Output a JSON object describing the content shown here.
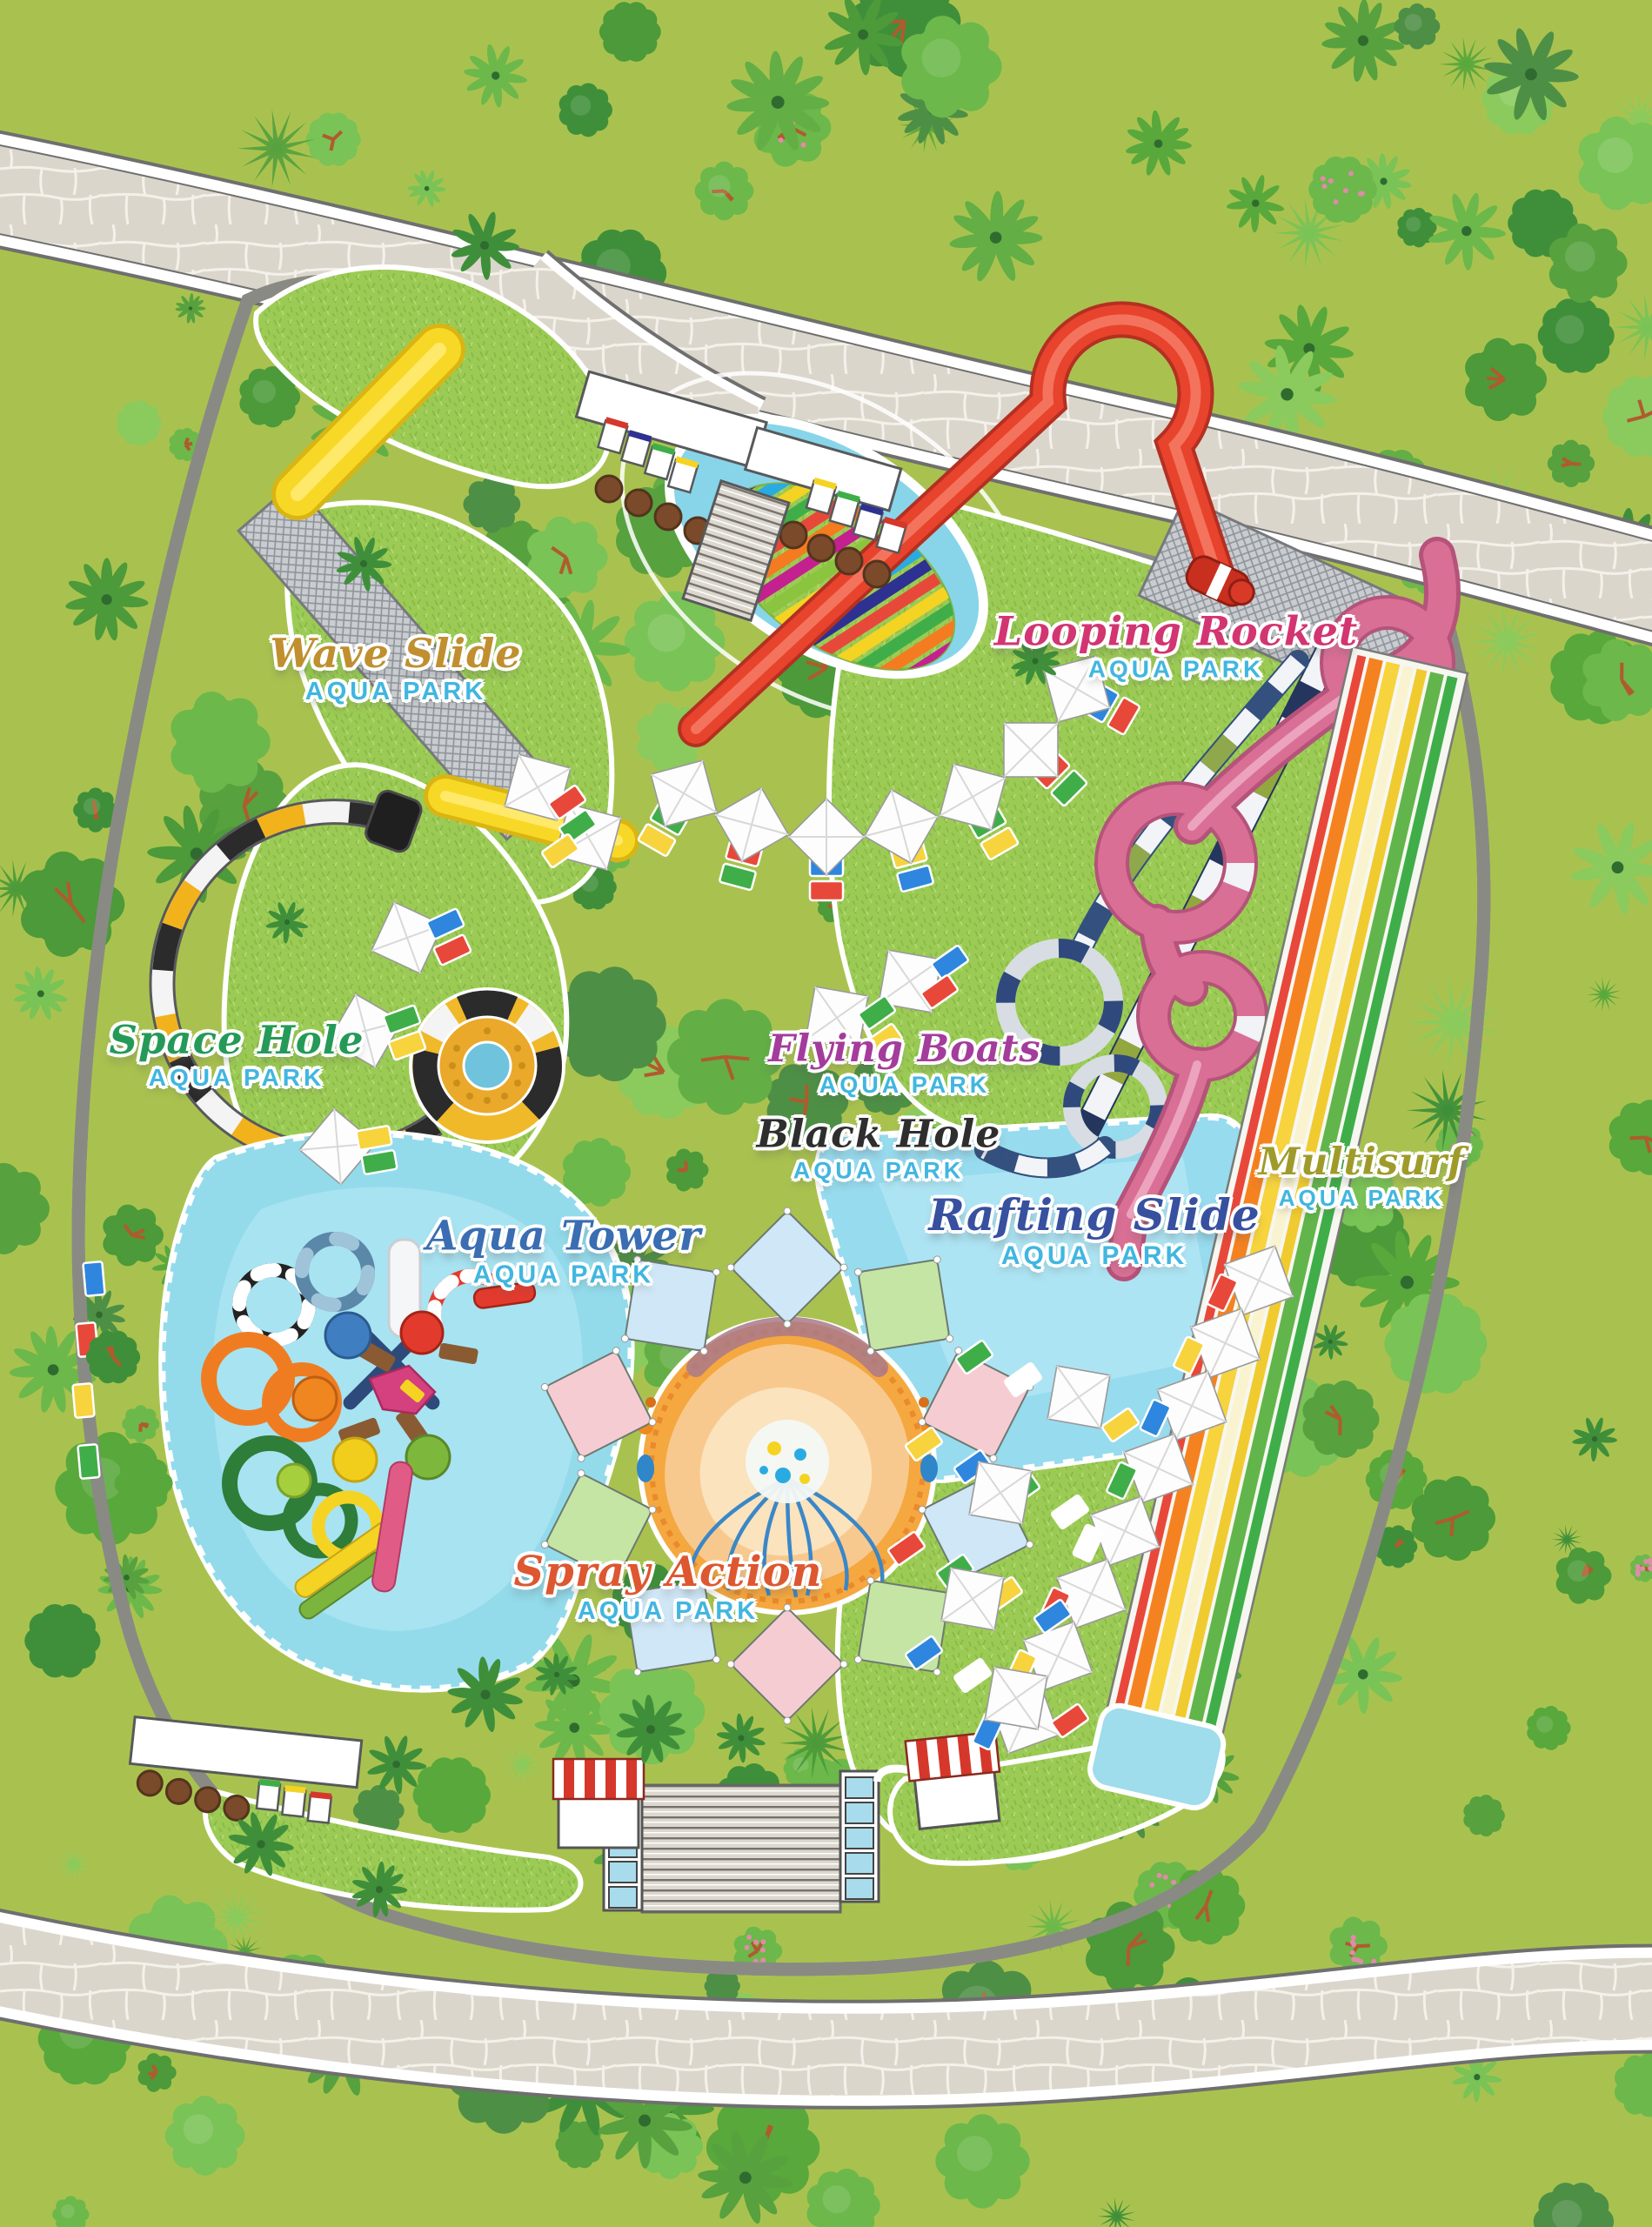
{
  "map": {
    "park_name": "AQUA PARK",
    "subtitle_color": "#41b6e0",
    "attractions": [
      {
        "id": "wave-slide",
        "title": "Wave Slide",
        "subtitle": "AQUA PARK",
        "title_color": "#c08f2f"
      },
      {
        "id": "looping-rocket",
        "title": "Looping Rocket",
        "subtitle": "AQUA PARK",
        "title_color": "#d23571"
      },
      {
        "id": "space-hole",
        "title": "Space Hole",
        "subtitle": "AQUA PARK",
        "title_color": "#259a58"
      },
      {
        "id": "flying-boats",
        "title": "Flying Boats",
        "subtitle": "AQUA PARK",
        "title_color": "#a43c9c"
      },
      {
        "id": "black-hole",
        "title": "Black Hole",
        "subtitle": "AQUA PARK",
        "title_color": "#2e2e2e"
      },
      {
        "id": "rafting-slide",
        "title": "Rafting Slide",
        "subtitle": "AQUA PARK",
        "title_color": "#37509f"
      },
      {
        "id": "multisurf",
        "title": "Multisurf",
        "subtitle": "AQUA PARK",
        "title_color": "#9f9b2a"
      },
      {
        "id": "aqua-tower",
        "title": "Aqua Tower",
        "subtitle": "AQUA PARK",
        "title_color": "#3a6db2"
      },
      {
        "id": "spray-action",
        "title": "Spray Action",
        "subtitle": "AQUA PARK",
        "title_color": "#dd5730"
      }
    ],
    "palette": {
      "forest_background": "#a9c24f",
      "lawn_green": "#9ccb55",
      "plaza_stone": "#dbd6cc",
      "water_blue": "#8ed7ea",
      "pool_edge_orange": "#f0a24a",
      "wave_slide_yellow": "#f8d826",
      "looping_rocket_red": "#e8432c",
      "rafting_slide_pink": "#d96f95",
      "black_hole_navy": "#24365e",
      "space_hole_black": "#2b2b2b",
      "space_hole_yellow": "#f2b21c",
      "multisurf_lanes": [
        "#e8483a",
        "#f58220",
        "#f7d33d",
        "#faf3cf",
        "#62b54a"
      ],
      "spray_pad_orange": "#f5a83f",
      "sail_colors": [
        "#cfe7f6",
        "#c5e5a5",
        "#f6ccd3"
      ],
      "sunbed_colors": [
        "#2e86de",
        "#e8483a",
        "#3fae49",
        "#f7d33d"
      ]
    }
  }
}
